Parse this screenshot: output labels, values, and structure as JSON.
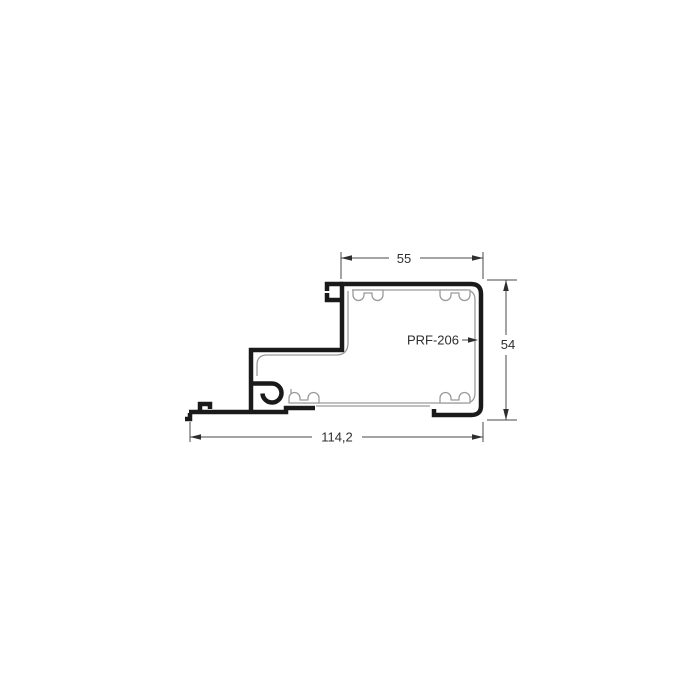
{
  "page": {
    "background": "#ffffff"
  },
  "drawing": {
    "profile_label": "PRF-206",
    "dimensions": {
      "top_width": "55",
      "right_height": "54",
      "bottom_width": "114,2"
    },
    "colors": {
      "outline": "#1a1a1a",
      "inner_lines": "#9b9b9b",
      "dimension_lines": "#4a4a4a",
      "arrowheads": "#2e2e2e",
      "text": "#2e2e2e",
      "background": "#ffffff"
    }
  }
}
